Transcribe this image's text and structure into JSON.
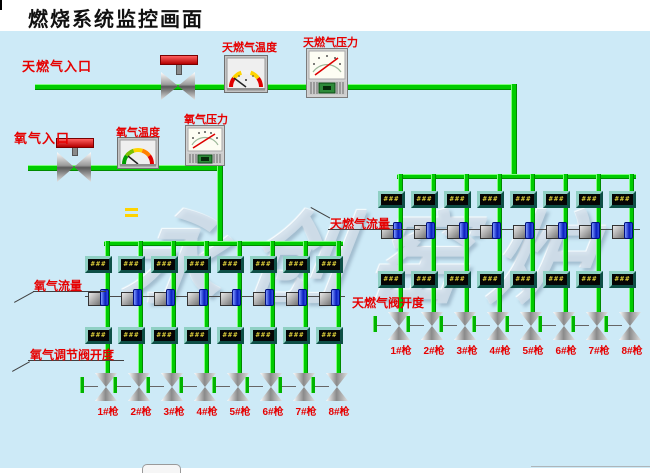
{
  "title": "燃烧系统监控画面",
  "watermark_text": "永创窑炉",
  "colors": {
    "background": "#cdeaf7",
    "pipe_green": "#00cc00",
    "label_red": "#e60000",
    "display_digits": "#f0e040",
    "display_bezel": "#2f8577",
    "actuator_blue": "#0a1ec0",
    "valve_handle_red": "#b40000"
  },
  "gas_line": {
    "inlet_label": "天燃气入口",
    "temperature_label": "天燃气温度",
    "pressure_label": "天燃气压力"
  },
  "oxygen_line": {
    "inlet_label": "氧气入口",
    "temperature_label": "氧气温度",
    "pressure_label": "氧气压力"
  },
  "oxygen_grid": {
    "flow_label": "氧气流量",
    "valve_opening_label": "氧气调节阀开度",
    "columns": [
      {
        "flow": "###",
        "opening": "###",
        "gun": "1#枪"
      },
      {
        "flow": "###",
        "opening": "###",
        "gun": "2#枪"
      },
      {
        "flow": "###",
        "opening": "###",
        "gun": "3#枪"
      },
      {
        "flow": "###",
        "opening": "###",
        "gun": "4#枪"
      },
      {
        "flow": "###",
        "opening": "###",
        "gun": "5#枪"
      },
      {
        "flow": "###",
        "opening": "###",
        "gun": "6#枪"
      },
      {
        "flow": "###",
        "opening": "###",
        "gun": "7#枪"
      },
      {
        "flow": "###",
        "opening": "###",
        "gun": "8#枪"
      }
    ]
  },
  "gas_grid": {
    "flow_label": "天燃气流量",
    "valve_opening_label": "天燃气阀开度",
    "columns": [
      {
        "flow": "###",
        "opening": "###",
        "gun": "1#枪"
      },
      {
        "flow": "###",
        "opening": "###",
        "gun": "2#枪"
      },
      {
        "flow": "###",
        "opening": "###",
        "gun": "3#枪"
      },
      {
        "flow": "###",
        "opening": "###",
        "gun": "4#枪"
      },
      {
        "flow": "###",
        "opening": "###",
        "gun": "5#枪"
      },
      {
        "flow": "###",
        "opening": "###",
        "gun": "6#枪"
      },
      {
        "flow": "###",
        "opening": "###",
        "gun": "7#枪"
      },
      {
        "flow": "###",
        "opening": "###",
        "gun": "8#枪"
      }
    ]
  }
}
